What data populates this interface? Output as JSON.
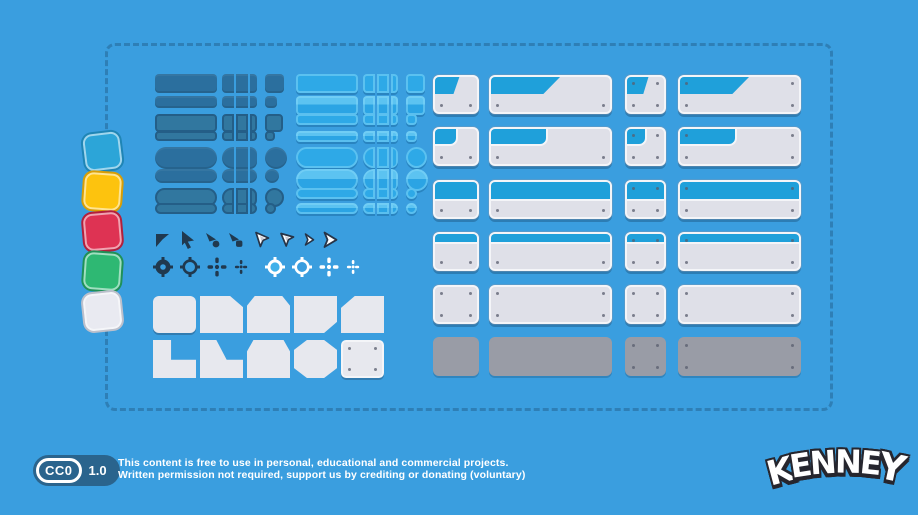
{
  "colors": {
    "background": "#3A9EDF",
    "dashed_border": "#2E7FB6",
    "dark_button": "#2B6F9E",
    "dark_button_outline": "#245E87",
    "light_button": "#2EA9E7",
    "light_button_highlight": "#82D6F8",
    "panel_body": "#DFE0E8",
    "panel_border": "#F4F5F8",
    "panel_header_blue": "#1FA0DA",
    "panel_gray": "#999CA6",
    "cursor_dark": "#20394F",
    "icon_white": "#FFFFFF"
  },
  "swatches": [
    {
      "name": "blue-swatch",
      "color": "#2CA5D8",
      "outline": "#1F85B5",
      "tilt": -7
    },
    {
      "name": "yellow-swatch",
      "color": "#FDC30E",
      "outline": "#D89E06",
      "tilt": 4
    },
    {
      "name": "red-swatch",
      "color": "#DE3353",
      "outline": "#B31F3C",
      "tilt": -5
    },
    {
      "name": "green-swatch",
      "color": "#2EB873",
      "outline": "#1F9158",
      "tilt": 4
    },
    {
      "name": "white-swatch",
      "color": "#E9EAF1",
      "outline": "#BCC0CC",
      "tilt": -6
    }
  ],
  "button_sections": {
    "dark": {
      "rows": [
        {
          "shape": "rect",
          "variant": "solid",
          "end": "square"
        },
        {
          "shape": "rect",
          "variant": "solid",
          "end": "square"
        },
        {
          "shape": "rect",
          "variant": "outline",
          "end": "square"
        },
        {
          "shape": "rect",
          "variant": "outline",
          "end": "square"
        },
        {
          "shape": "pill",
          "variant": "solid",
          "end": "circle"
        },
        {
          "shape": "pill",
          "variant": "solid",
          "end": "circle"
        },
        {
          "shape": "pill",
          "variant": "outline",
          "end": "circle"
        },
        {
          "shape": "pill",
          "variant": "outline",
          "end": "circle"
        }
      ]
    },
    "light": {
      "rows": [
        {
          "shape": "rect",
          "variant": "flat",
          "end": "square"
        },
        {
          "shape": "rect",
          "variant": "bevel",
          "end": "square"
        },
        {
          "shape": "rect",
          "variant": "flat",
          "end": "square"
        },
        {
          "shape": "rect",
          "variant": "bevel",
          "end": "square"
        },
        {
          "shape": "pill",
          "variant": "flat",
          "end": "circle"
        },
        {
          "shape": "pill",
          "variant": "bevel",
          "end": "circle"
        },
        {
          "shape": "pill",
          "variant": "flat",
          "end": "circle"
        },
        {
          "shape": "pill",
          "variant": "bevel",
          "end": "circle"
        }
      ]
    }
  },
  "icons": {
    "cursors": [
      "flag-cursor-dark",
      "arrow-cursor-dark",
      "corner-cursor-dot-dark",
      "corner-cursor-square-dark",
      "kite-pointer-white",
      "kite-pointer-white-alt",
      "dart-cursor-small-white",
      "dart-cursor-large-white"
    ],
    "crosshairs": [
      "target-gear-dark",
      "target-ring-dark",
      "plus-crosshair-dark",
      "plus-crosshair-small-dark",
      "target-gear-blue",
      "target-ring-white",
      "plus-crosshair-white",
      "plus-crosshair-small-white"
    ]
  },
  "panel_shapes": [
    "square-panel",
    "cut-top-right-panel",
    "cut-top-corners-panel",
    "cut-bottom-right-panel",
    "cut-top-left-panel",
    "step-panel",
    "slope-step-panel",
    "beveled-top-panel",
    "octagon-panel",
    "screwed-square-panel"
  ],
  "panels_grid": {
    "columns": [
      {
        "kind": "small-panel",
        "screws": "bottom"
      },
      {
        "kind": "wide-panel",
        "screws": "bottom"
      },
      {
        "kind": "small-panel",
        "screws": "all"
      },
      {
        "kind": "wide-panel",
        "screws": "all"
      }
    ],
    "rows": [
      {
        "header": "diagonal"
      },
      {
        "header": "tab"
      },
      {
        "header": "full"
      },
      {
        "header": "strip"
      },
      {
        "header": "none",
        "screws_override": "all"
      },
      {
        "header": "none",
        "gray": true
      }
    ]
  },
  "footer": {
    "badge_cc": "CC0",
    "badge_version": "1.0",
    "license_line1": "This content is free to use in personal, educational and commercial projects.",
    "license_line2": "Written permission not required, support us by crediting or donating (voluntary)",
    "logo_text": "KENNEY"
  }
}
